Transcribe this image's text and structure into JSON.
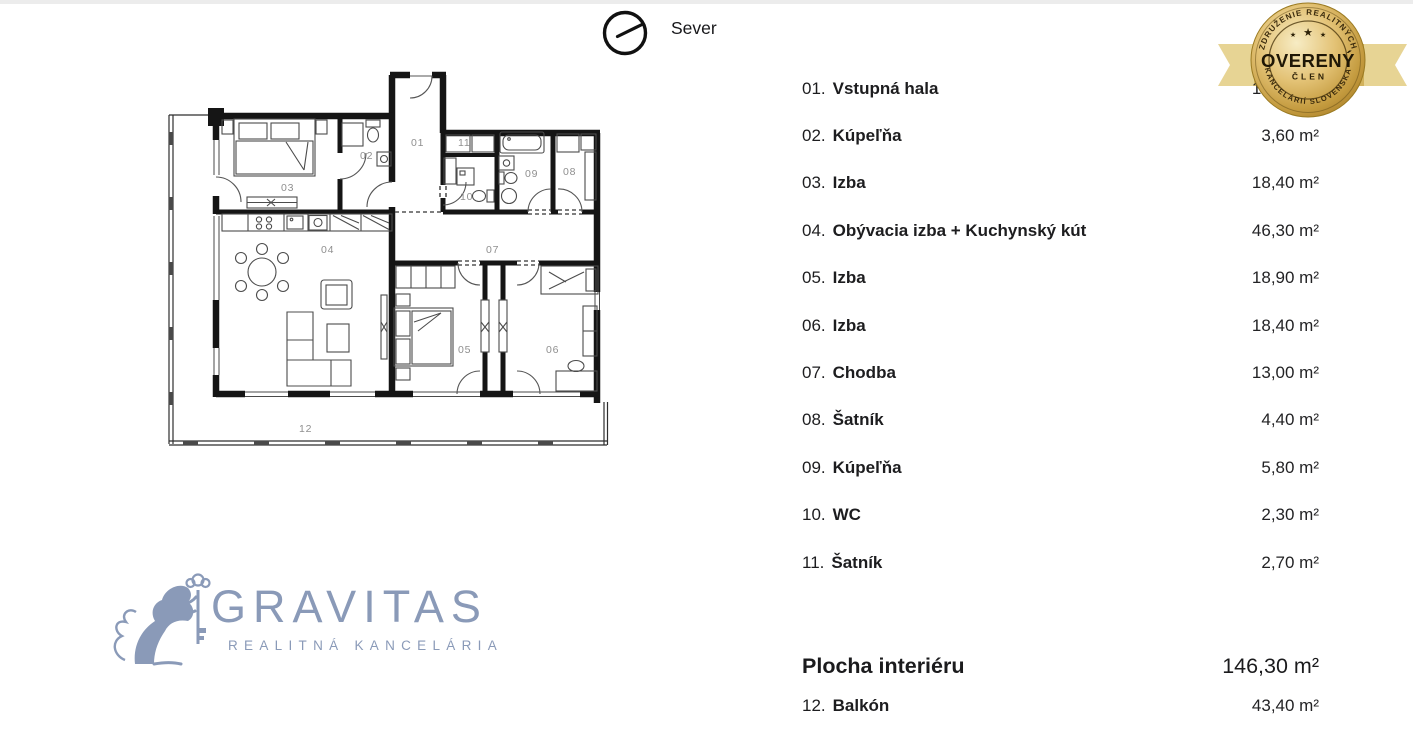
{
  "compass": {
    "label": "Sever"
  },
  "badge": {
    "arc_top": "ZDRUŽENIE REALITNÝCH",
    "arc_bottom": "KANCELÁRIÍ SLOVENSKA",
    "title": "OVERENÝ",
    "member": "ČLEN",
    "stars": [
      "★",
      "★",
      "★"
    ],
    "gold_color": "#c9a24b",
    "ribbon_color": "#e7d494"
  },
  "logo": {
    "wordmark": "GRAVITAS",
    "tagline": "REALITNÁ KANCELÁRIA",
    "color": "#8a9ab8"
  },
  "rooms": [
    {
      "num": "01.",
      "name": "Vstupná hala",
      "area": "12,50 m²"
    },
    {
      "num": "02.",
      "name": "Kúpeľňa",
      "area": "3,60 m²"
    },
    {
      "num": "03.",
      "name": "Izba",
      "area": "18,40 m²"
    },
    {
      "num": "04.",
      "name": "Obývacia izba + Kuchynský kút",
      "area": "46,30 m²"
    },
    {
      "num": "05.",
      "name": "Izba",
      "area": "18,90 m²"
    },
    {
      "num": "06.",
      "name": "Izba",
      "area": "18,40 m²"
    },
    {
      "num": "07.",
      "name": "Chodba",
      "area": "13,00 m²"
    },
    {
      "num": "08.",
      "name": "Šatník",
      "area": "4,40 m²"
    },
    {
      "num": "09.",
      "name": "Kúpeľňa",
      "area": "5,80 m²"
    },
    {
      "num": "10.",
      "name": "WC",
      "area": "2,30 m²"
    },
    {
      "num": "11.",
      "name": "Šatník",
      "area": "2,70 m²"
    }
  ],
  "summary": {
    "label": "Plocha interiéru",
    "value": "146,30 m²"
  },
  "balcony": {
    "num": "12.",
    "name": "Balkón",
    "area": "43,40 m²"
  },
  "floorplan": {
    "labels": [
      "01",
      "02",
      "03",
      "04",
      "05",
      "06",
      "07",
      "08",
      "09",
      "10",
      "11",
      "12"
    ]
  }
}
